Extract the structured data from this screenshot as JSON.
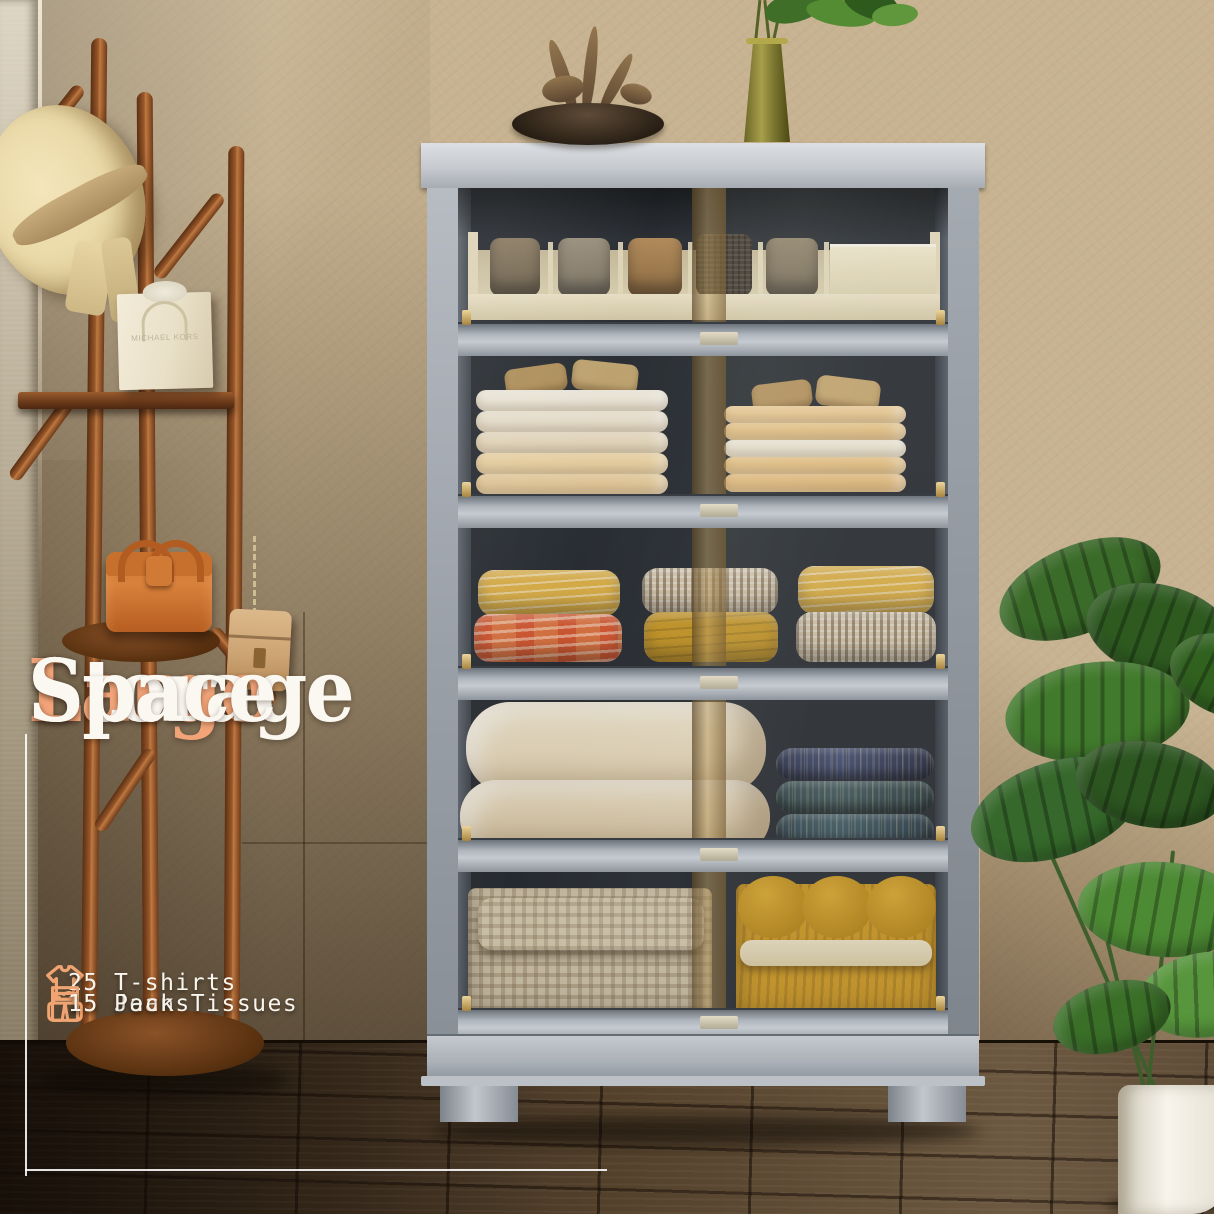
{
  "overlay": {
    "headline": {
      "line1": "Large",
      "line2": "Storage",
      "line3": "Space"
    },
    "features": [
      {
        "icon": "tshirt-icon",
        "label": "25 T-shirts"
      },
      {
        "icon": "jeans-icon",
        "label": "15 Jeans"
      },
      {
        "icon": "tissue-box-icon",
        "label": "15 Pack Tissues"
      }
    ],
    "accent_color": "#F2A478",
    "text_color": "#FFFFFF"
  },
  "scene": {
    "shopping_bag_text": "MICHAEL KORS",
    "cabinet": {
      "shelf_count": 5,
      "body_color": "#AEB4BB",
      "interior_color": "#24282D",
      "handle_strip_color": "#A8895B",
      "contents": [
        "watch-organizer-tray",
        "folded-shirt-stacks",
        "folded-blanket-rolls",
        "rolled-comforters-and-vacuum-bags",
        "gingham-comforter-and-mustard-blanket"
      ]
    },
    "props": [
      "coat-rack",
      "straw-hat",
      "shopping-bag",
      "orange-handbag",
      "hanging-crossbody-bag",
      "decor-bowl",
      "green-glass-vase",
      "monstera-plant",
      "white-planter-pot"
    ],
    "palette": {
      "wall_beige": "#C7B391",
      "floor_wood": "#4A3928",
      "rack_wood": "#8A4F26",
      "hat_straw": "#EDDCAC",
      "handbag_orange": "#C96F2E",
      "plant_green": "#3E6B2F"
    }
  }
}
